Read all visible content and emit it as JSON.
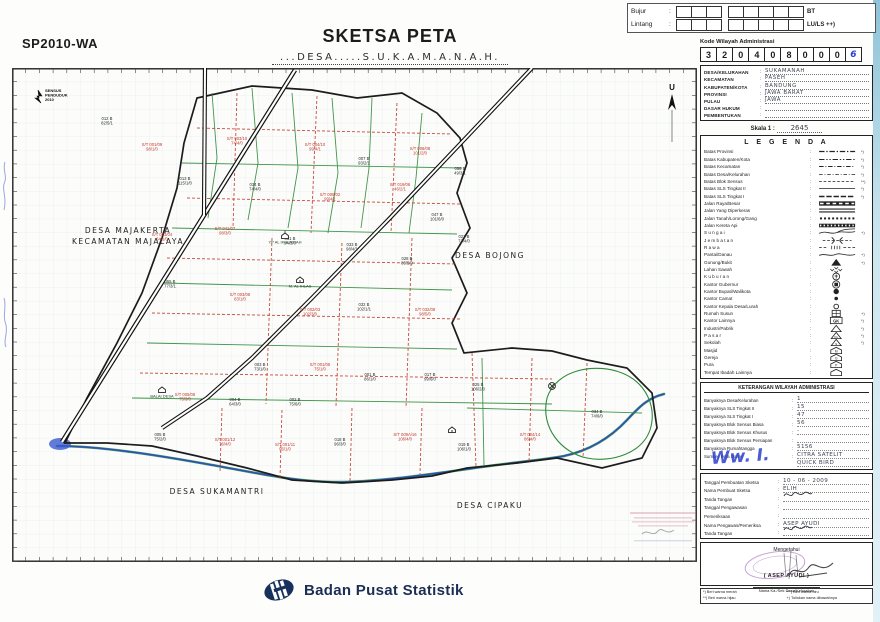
{
  "page": {
    "form_code": "SP2010-WA",
    "title": "SKETSA PETA",
    "subtitle": "...DESA.....S.U.K.A.M.A.N.A.H."
  },
  "coord_box": {
    "rows": [
      {
        "label": "Bujur",
        "suffix": "BT",
        "cells": [
          3,
          5
        ]
      },
      {
        "label": "Lintang",
        "suffix": "LU/LS ++)",
        "cells": [
          3,
          5
        ]
      }
    ]
  },
  "admin_code": {
    "title": "Kode Wilayah Administrasi",
    "digits": [
      "3",
      "2",
      "0",
      "4",
      "0",
      "8",
      "0",
      "0",
      "0",
      "6"
    ]
  },
  "admin_fields": {
    "rows": [
      {
        "label": "DESA/KELURAHAN",
        "value": "SUKAMANAH"
      },
      {
        "label": "KECAMATAN",
        "value": "PASEH"
      },
      {
        "label": "KABUPATEN/KOTA",
        "value": "BANDUNG"
      },
      {
        "label": "PROVINSI",
        "value": "JAWA BARAT"
      },
      {
        "label": "PULAU",
        "value": "JAWA"
      },
      {
        "label": "DASAR HUKUM",
        "value": ""
      },
      {
        "label": "PEMBENTUKAN",
        "value": ""
      }
    ]
  },
  "scale": {
    "label": "Skala 1 :",
    "value": "2645"
  },
  "legend": {
    "title": "L E G E N D A",
    "items": [
      {
        "label": "Batas Provinsi",
        "symbol": "b-prov",
        "note": "*)"
      },
      {
        "label": "Batas Kabupaten/Kota",
        "symbol": "b-kab",
        "note": "*)"
      },
      {
        "label": "Batas Kecamatan",
        "symbol": "b-kec",
        "note": "*)"
      },
      {
        "label": "Batas Desa/Kelurahan",
        "symbol": "b-desa",
        "note": "*)"
      },
      {
        "label": "Batas Blok Sensus",
        "symbol": "b-blok",
        "note": "**)"
      },
      {
        "label": "Batas SLS Tingkat II",
        "symbol": "b-sls2",
        "note": "*)"
      },
      {
        "label": "Batas SLS Tingkat I",
        "symbol": "b-sls1",
        "note": "*)"
      },
      {
        "label": "Jalan Raya/Besar",
        "symbol": "jalan-raya",
        "note": ""
      },
      {
        "label": "Jalan Yang Diperkeras",
        "symbol": "jalan-keras",
        "note": ""
      },
      {
        "label": "Jalan Tanah/Lorong/Gang",
        "symbol": "jalan-tanah",
        "note": ""
      },
      {
        "label": "Jalan Kereta Api",
        "symbol": "kereta",
        "note": ""
      },
      {
        "label": "S u n g a i",
        "symbol": "sungai",
        "note": "+)"
      },
      {
        "label": "J e m b a t a n",
        "symbol": "jembatan",
        "note": ""
      },
      {
        "label": "R a w a",
        "symbol": "rawa",
        "note": ""
      },
      {
        "label": "Pantai/Danau",
        "symbol": "pantai",
        "note": "+)"
      },
      {
        "label": "Gunung/Bukit",
        "symbol": "gunung",
        "note": "+)"
      },
      {
        "label": "Lahan Sawah",
        "symbol": "sawah",
        "note": ""
      },
      {
        "label": "K u b u r a n",
        "symbol": "kuburan",
        "note": ""
      },
      {
        "label": "Kantor Gubernur",
        "symbol": "k-gub",
        "note": ""
      },
      {
        "label": "Kantor Bupati/Walikota",
        "symbol": "k-bup",
        "note": ""
      },
      {
        "label": "Kantor Camat",
        "symbol": "k-camat",
        "note": ""
      },
      {
        "label": "Kantor Kepala Desa/Lurah",
        "symbol": "k-desa",
        "note": ""
      },
      {
        "label": "Rumah Susun",
        "symbol": "rusun",
        "note": "+)"
      },
      {
        "label": "Kantor Lainnya",
        "symbol": "k-lain",
        "note": "*)"
      },
      {
        "label": "Industri/Pabrik",
        "symbol": "industri",
        "note": "*)"
      },
      {
        "label": "P a s a r",
        "symbol": "pasar",
        "note": "*)"
      },
      {
        "label": "Sekolah",
        "symbol": "sekolah",
        "note": "*)"
      },
      {
        "label": "Masjid",
        "symbol": "masjid",
        "note": ""
      },
      {
        "label": "Gereja",
        "symbol": "gereja",
        "note": ""
      },
      {
        "label": "Pura",
        "symbol": "pura",
        "note": ""
      },
      {
        "label": "Tempat Ibadah Lainnya",
        "symbol": "ibadah",
        "note": ""
      }
    ]
  },
  "keterangan": {
    "title": "KETERANGAN WILAYAH ADMINISTRASI",
    "rows": [
      {
        "label": "Banyaknya Desa/Kelurahan",
        "value": "1"
      },
      {
        "label": "Banyaknya SLS Tingkat II",
        "value": "15"
      },
      {
        "label": "Banyaknya SLS Tingkat I",
        "value": "47"
      },
      {
        "label": "Banyaknya Blok Sensus Biasa",
        "value": "56"
      },
      {
        "label": "Banyaknya Blok Sensus Khusus",
        "value": "-"
      },
      {
        "label": "Banyaknya Blok Sensus Persiapan",
        "value": ""
      },
      {
        "label": "Banyaknya Rumahtangga",
        "value": "5156"
      },
      {
        "label": "Sumber Peta Dasar",
        "value": "CITRA SATELIT",
        "value2": "QUICK BIRD"
      }
    ],
    "scrawl": "Ww. I."
  },
  "sketsa_info": {
    "rows": [
      {
        "label": "Tanggal Pembuatan Sketsa",
        "value": "10 - 06 - 2009"
      },
      {
        "label": "Nama Pembuat Sketsa",
        "value": "ELIH"
      },
      {
        "label": "Tanda Tangan",
        "value": "",
        "sig": true
      },
      {
        "label": "Tanggal Pengawasan",
        "value": ""
      },
      {
        "label": "Pemeriksaan",
        "value": ""
      },
      {
        "label": "Nama Pengawas/Pemeriksa",
        "value": "ASEP AYUDI"
      },
      {
        "label": "Tanda Tangan",
        "value": "",
        "sig": true
      }
    ]
  },
  "mengetahui": {
    "title": "Mengetahui",
    "name": "( ASEP AYUDI )",
    "caption": "Nama Ka./Sek Desa/Kelurahan"
  },
  "footnotes": {
    "items": [
      "*) Beri warna merah",
      "**) Beri warna hijau",
      "***) Beri warna biru",
      "+) Tuliskan nama dibawahnya"
    ]
  },
  "map": {
    "census_logo": [
      "SENSUS",
      "PENDUDUK",
      "2010"
    ],
    "north_label": "U",
    "regions": [
      {
        "lines": [
          "DESA MAJAKERTA",
          "KECAMATAN MAJALAYA"
        ],
        "x": 116,
        "y": 165
      },
      {
        "lines": [
          "DESA BOJONG"
        ],
        "x": 478,
        "y": 190
      },
      {
        "lines": [
          "DESA SUKAMANTRI"
        ],
        "x": 205,
        "y": 426
      },
      {
        "lines": [
          "DESA CIPAKU"
        ],
        "x": 478,
        "y": 440
      }
    ],
    "landmarks": [
      {
        "icon": "school",
        "label": "YP AL IKHLASIAH",
        "x": 273,
        "y": 168
      },
      {
        "icon": "mosque",
        "label": "M. AL IHLAS",
        "x": 288,
        "y": 212
      },
      {
        "icon": "office",
        "label": "BALAI DESA",
        "x": 150,
        "y": 322
      },
      {
        "icon": "mosque",
        "label": "",
        "x": 440,
        "y": 362
      },
      {
        "icon": "kuburan",
        "label": "",
        "x": 540,
        "y": 318
      }
    ],
    "parcels": [
      {
        "x": 95,
        "y": 52,
        "t1": "012 B",
        "t2": "82/5/1",
        "c": "k"
      },
      {
        "x": 140,
        "y": 78,
        "t1": "S/T 001/09",
        "t2": "98/1/0",
        "c": "r"
      },
      {
        "x": 225,
        "y": 72,
        "t1": "S/T 003/10",
        "t2": "74/4/0",
        "c": "r"
      },
      {
        "x": 303,
        "y": 78,
        "t1": "S/T 004/10",
        "t2": "99/4/1",
        "c": "r"
      },
      {
        "x": 352,
        "y": 92,
        "t1": "007 B",
        "t2": "93/2/1",
        "c": "k"
      },
      {
        "x": 408,
        "y": 82,
        "t1": "S/T 006/08",
        "t2": "101/2/0",
        "c": "r"
      },
      {
        "x": 448,
        "y": 102,
        "t1": "058 B",
        "t2": "49/3/1",
        "c": "k"
      },
      {
        "x": 173,
        "y": 112,
        "t1": "013 B",
        "t2": "115/1/0",
        "c": "k"
      },
      {
        "x": 243,
        "y": 118,
        "t1": "034 B",
        "t2": "74/4/0",
        "c": "k"
      },
      {
        "x": 318,
        "y": 128,
        "t1": "S/T 005/02",
        "t2": "99/4/1",
        "c": "r"
      },
      {
        "x": 388,
        "y": 118,
        "t1": "S/T 019/06",
        "t2": "46/2/1",
        "c": "r"
      },
      {
        "x": 425,
        "y": 148,
        "t1": "047 B",
        "t2": "101/6/0",
        "c": "k"
      },
      {
        "x": 452,
        "y": 170,
        "t1": "027 B",
        "t2": "73/4/0",
        "c": "k"
      },
      {
        "x": 150,
        "y": 168,
        "t1": "S/T 003/04",
        "t2": "64/1/0",
        "c": "r"
      },
      {
        "x": 213,
        "y": 162,
        "t1": "S/T 041/07",
        "t2": "98/3/0",
        "c": "r"
      },
      {
        "x": 278,
        "y": 172,
        "t1": "031 B",
        "t2": "94/3/0",
        "c": "k"
      },
      {
        "x": 340,
        "y": 178,
        "t1": "033 B",
        "t2": "98/4/1",
        "c": "k"
      },
      {
        "x": 395,
        "y": 192,
        "t1": "028 B",
        "t2": "83/5/0",
        "c": "k"
      },
      {
        "x": 158,
        "y": 215,
        "t1": "055 B",
        "t2": "77/3/1",
        "c": "k"
      },
      {
        "x": 228,
        "y": 228,
        "t1": "S/T 003/08",
        "t2": "83/1/0",
        "c": "r"
      },
      {
        "x": 298,
        "y": 243,
        "t1": "S/T 002/03",
        "t2": "102/3/0",
        "c": "r"
      },
      {
        "x": 352,
        "y": 238,
        "t1": "032 B",
        "t2": "102/1/1",
        "c": "k"
      },
      {
        "x": 413,
        "y": 243,
        "t1": "S/T 032/08",
        "t2": "98/5/0",
        "c": "r"
      },
      {
        "x": 248,
        "y": 298,
        "t1": "003 B",
        "t2": "73/1/0",
        "c": "k"
      },
      {
        "x": 308,
        "y": 298,
        "t1": "S/T 001/05",
        "t2": "75/1/0",
        "c": "r"
      },
      {
        "x": 358,
        "y": 308,
        "t1": "001 B",
        "t2": "86/1/0",
        "c": "k"
      },
      {
        "x": 418,
        "y": 308,
        "t1": "017 B",
        "t2": "99/6/0",
        "c": "k"
      },
      {
        "x": 466,
        "y": 318,
        "t1": "025 B",
        "t2": "106/2/0",
        "c": "k"
      },
      {
        "x": 173,
        "y": 328,
        "t1": "S/T 005/08",
        "t2": "75/3/0",
        "c": "r"
      },
      {
        "x": 223,
        "y": 333,
        "t1": "004 B",
        "t2": "64/3/0",
        "c": "k"
      },
      {
        "x": 283,
        "y": 333,
        "t1": "002 B",
        "t2": "75/6/0",
        "c": "k"
      },
      {
        "x": 148,
        "y": 368,
        "t1": "005 B",
        "t2": "75/2/0",
        "c": "k"
      },
      {
        "x": 213,
        "y": 373,
        "t1": "S/T 001/12",
        "t2": "76/4/0",
        "c": "r"
      },
      {
        "x": 273,
        "y": 378,
        "t1": "S/T 001/11",
        "t2": "96/1/0",
        "c": "r"
      },
      {
        "x": 328,
        "y": 373,
        "t1": "018 B",
        "t2": "96/3/0",
        "c": "k"
      },
      {
        "x": 393,
        "y": 368,
        "t1": "S/T 009A/16",
        "t2": "106/4/0",
        "c": "r"
      },
      {
        "x": 452,
        "y": 378,
        "t1": "019 B",
        "t2": "106/1/0",
        "c": "k"
      },
      {
        "x": 518,
        "y": 368,
        "t1": "S/T 004/14",
        "t2": "86/4/0",
        "c": "r"
      },
      {
        "x": 585,
        "y": 345,
        "t1": "034 B",
        "t2": "74/6/0",
        "c": "k"
      }
    ]
  },
  "footer": {
    "agency": "Badan Pusat Statistik"
  },
  "colors": {
    "red": "#c03a2b",
    "green": "#2e8b3a",
    "river_blue": "#2b4fc0",
    "ink": "#1c1c1c",
    "hand_blue": "#2b3fd0",
    "stamp_purple": "#9b59b6"
  }
}
